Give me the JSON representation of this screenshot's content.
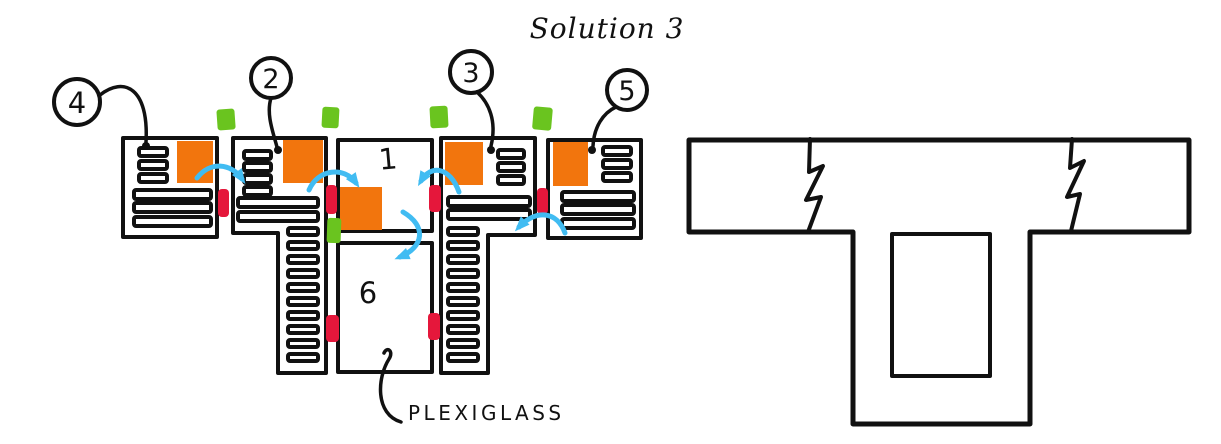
{
  "title": "Solution 3",
  "callouts": {
    "two": "2",
    "three": "3",
    "four": "4",
    "five": "5"
  },
  "modules": {
    "one": "1",
    "six": "6"
  },
  "annotations": {
    "plexiglass": "PLEXIGLASS"
  },
  "colors": {
    "ink": "#111111",
    "orange": "#F2750D",
    "green": "#6AC41F",
    "red": "#E5173B",
    "blue": "#41BCF2",
    "paper": "#FFFFFF"
  }
}
